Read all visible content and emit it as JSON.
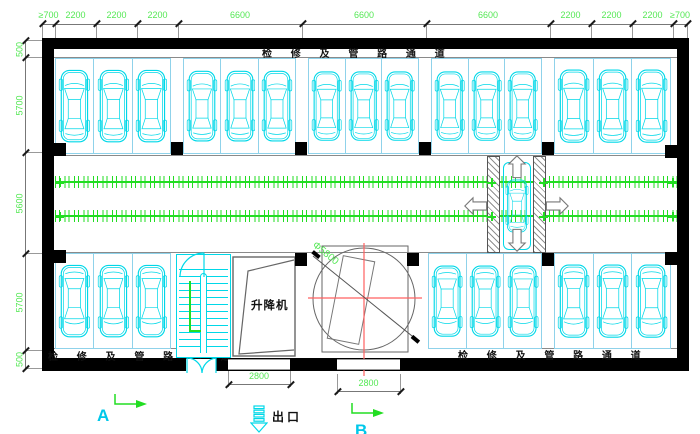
{
  "passages": {
    "top": "检 修 及 管 路 通 道",
    "bottom_left": "检 修 及 管 路 通 道",
    "bottom_right": "检 修 及 管 路 通 道"
  },
  "rooms": {
    "lift": "升降机"
  },
  "turntable": {
    "diameter_label": "Φ5800"
  },
  "exit": {
    "label": "出口"
  },
  "axes": {
    "a": "A",
    "b": "B"
  },
  "dimensions": {
    "top": [
      "≥700",
      "2200",
      "2200",
      "2200",
      "6600",
      "6600",
      "6600",
      "2200",
      "2200",
      "2200",
      "≥700"
    ],
    "left": [
      "500",
      "5700",
      "5600",
      "5700",
      "500"
    ],
    "bottom": [
      "2800",
      "2800"
    ]
  },
  "parking": {
    "rows": [
      {
        "name": "top-row",
        "groups": [
          3,
          3,
          3,
          3,
          3
        ],
        "car_facing": "front-up"
      },
      {
        "name": "bottom-row",
        "groups": [
          3,
          3,
          3
        ],
        "car_facing": "front-down"
      }
    ],
    "corridor_car": 1,
    "visible_car_count": 25
  },
  "colors": {
    "car": "#00d8e8",
    "spot_line": "#8fd2ea",
    "dimension_text": "#55e855",
    "conveyor_track": "#22dd22",
    "centerline_red": "#ff6060",
    "wall": "#000000",
    "annotation_cyan": "#00c8ea"
  }
}
